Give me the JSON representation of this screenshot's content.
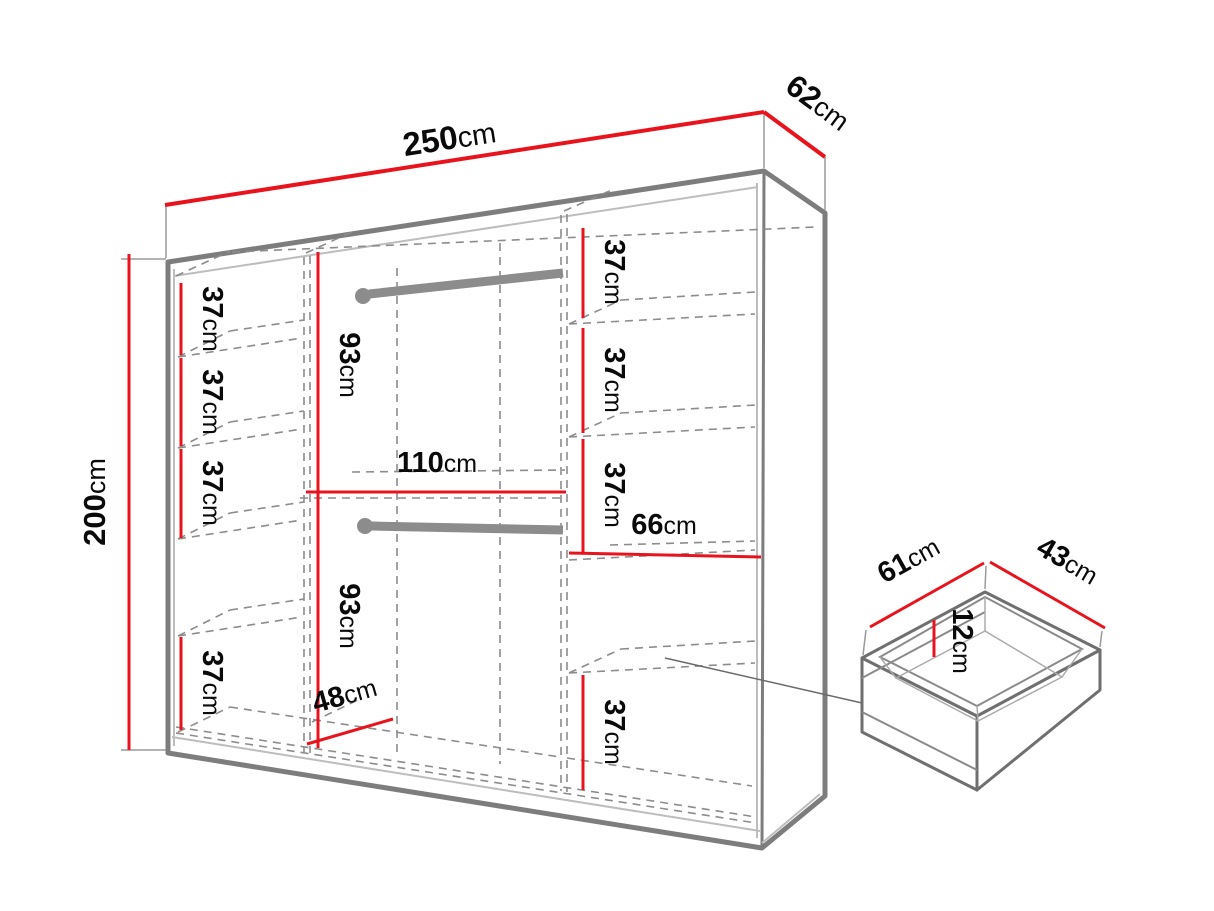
{
  "colors": {
    "background": "#ffffff",
    "dimension_red": "#e9131d",
    "outline_gray": "#7d7d7d",
    "hidden_line_gray": "#8c8c8c",
    "light_gray": "#bdbdbd",
    "rod_gray": "#8c8c8c",
    "text_black": "#0a0a0a"
  },
  "wardrobe": {
    "width": {
      "value": "250",
      "unit": "cm"
    },
    "depth": {
      "value": "62",
      "unit": "cm"
    },
    "height": {
      "value": "200",
      "unit": "cm"
    },
    "left_column": {
      "shelf_heights": [
        {
          "value": "37",
          "unit": "cm"
        },
        {
          "value": "37",
          "unit": "cm"
        },
        {
          "value": "37",
          "unit": "cm"
        },
        {
          "value": "37",
          "unit": "cm"
        }
      ]
    },
    "middle_column": {
      "upper_hanging_height": {
        "value": "93",
        "unit": "cm"
      },
      "width": {
        "value": "110",
        "unit": "cm"
      },
      "lower_hanging_height": {
        "value": "93",
        "unit": "cm"
      },
      "bottom_depth": {
        "value": "48",
        "unit": "cm"
      }
    },
    "right_column": {
      "shelf_heights": [
        {
          "value": "37",
          "unit": "cm"
        },
        {
          "value": "37",
          "unit": "cm"
        },
        {
          "value": "37",
          "unit": "cm"
        }
      ],
      "width": {
        "value": "66",
        "unit": "cm"
      },
      "bottom_shelf_height": {
        "value": "37",
        "unit": "cm"
      }
    }
  },
  "drawer": {
    "width": {
      "value": "61",
      "unit": "cm"
    },
    "depth": {
      "value": "43",
      "unit": "cm"
    },
    "inner_height": {
      "value": "12",
      "unit": "cm"
    }
  }
}
